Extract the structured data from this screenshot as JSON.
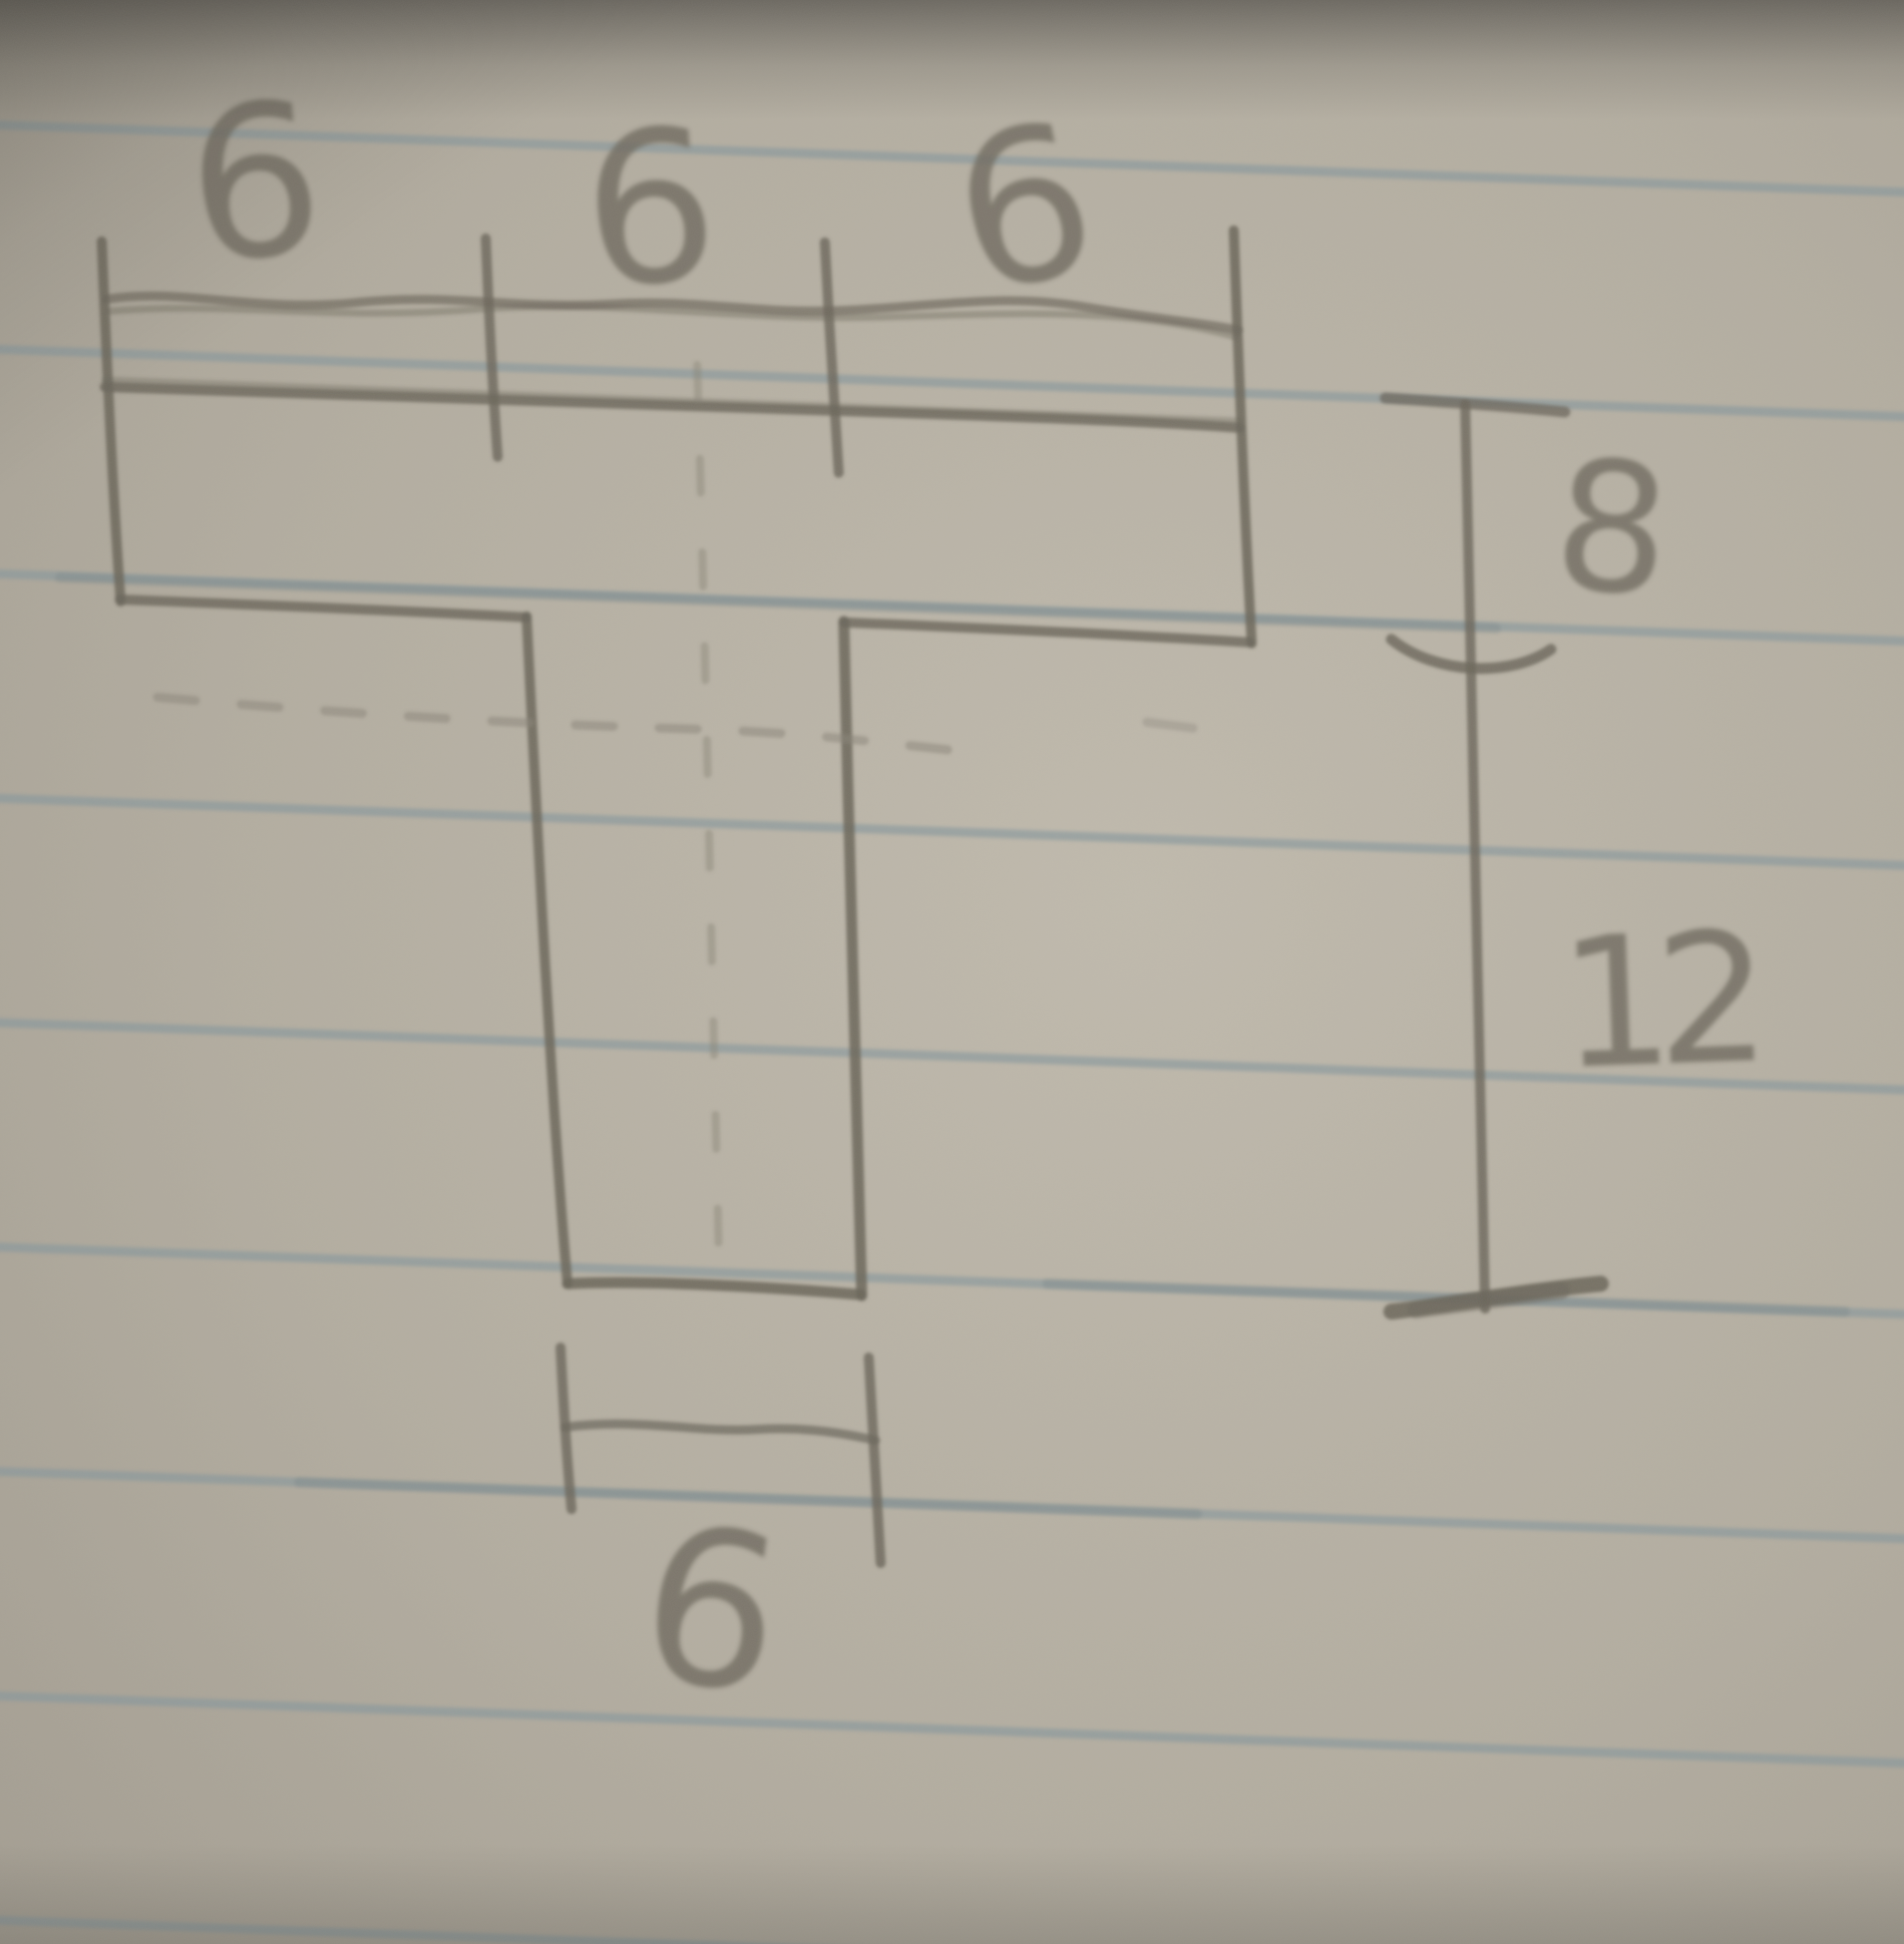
{
  "document": {
    "kind": "hand-drawn engineering sketch",
    "subject": "T-shaped cross-section (T-beam) with dimension lines on ruled notebook paper"
  },
  "labels": {
    "top_segment_left": "6",
    "top_segment_middle": "6",
    "top_segment_right": "6",
    "flange_thickness": "8",
    "stem_height": "12",
    "stem_width": "6"
  },
  "dimensions_summary": {
    "flange_width_segments": [
      "6",
      "6",
      "6"
    ],
    "flange_thickness": "8",
    "stem_height": "12",
    "stem_width": "6"
  },
  "colors": {
    "paper_base": "#b4aea1",
    "paper_light": "#c0baad",
    "paper_shadow": "#968f84",
    "ruled_line": "#86979d",
    "pencil": "#6b665b",
    "pencil_soft": "#8a8477",
    "label_ink": "#6f6a5f"
  }
}
